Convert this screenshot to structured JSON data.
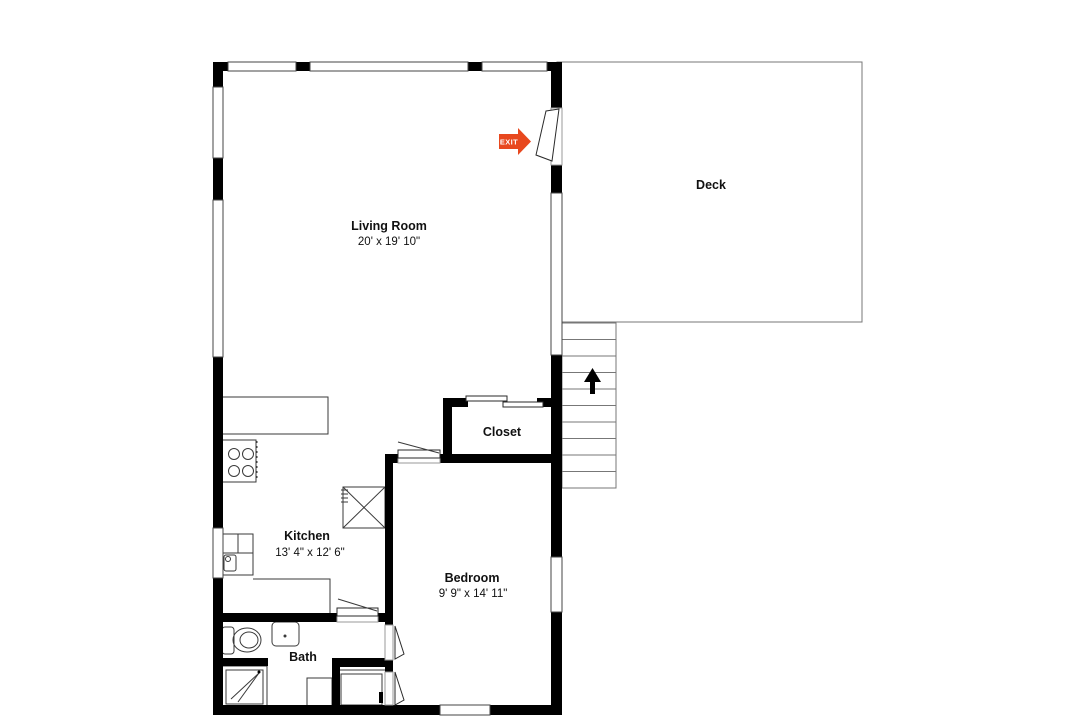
{
  "plan": {
    "background": "#ffffff",
    "wall_color": "#000000",
    "line_color": "#3a3a3a",
    "text_color": "#111111",
    "rooms": {
      "living_room": {
        "name": "Living Room",
        "dims": "20' x 19' 10\""
      },
      "deck": {
        "name": "Deck"
      },
      "closet": {
        "name": "Closet"
      },
      "kitchen": {
        "name": "Kitchen",
        "dims": "13' 4\" x 12' 6\""
      },
      "bedroom": {
        "name": "Bedroom",
        "dims": "9' 9\" x 14' 11\""
      },
      "bath": {
        "name": "Bath"
      }
    },
    "exit_sign": {
      "label": "EXIT",
      "color": "#e8481e"
    },
    "stairs": {
      "direction": "up",
      "arrow_icon": "up-arrow"
    }
  }
}
